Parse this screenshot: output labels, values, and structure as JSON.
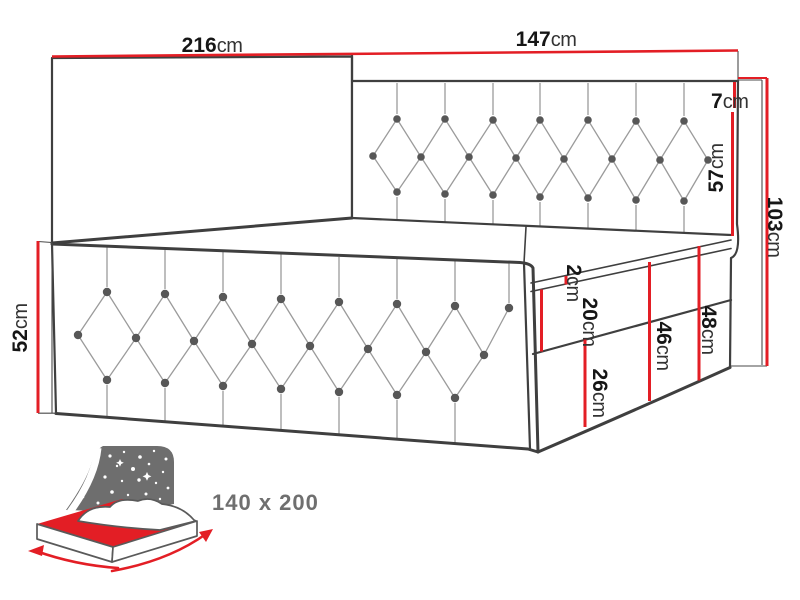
{
  "dims": {
    "length": {
      "num": "216",
      "unit": "cm"
    },
    "width": {
      "num": "147",
      "unit": "cm"
    },
    "headboard_top": {
      "num": "7",
      "unit": "cm"
    },
    "headboard": {
      "num": "57",
      "unit": "cm"
    },
    "height": {
      "num": "103",
      "unit": "cm"
    },
    "side": {
      "num": "52",
      "unit": "cm"
    },
    "piping": {
      "num": "2",
      "unit": "cm"
    },
    "mattress": {
      "num": "20",
      "unit": "cm"
    },
    "base_lower": {
      "num": "26",
      "unit": "cm"
    },
    "base_upper": {
      "num": "46",
      "unit": "cm"
    },
    "base_total": {
      "num": "48",
      "unit": "cm"
    }
  },
  "badge": {
    "size_label": "140 x 200",
    "icon": "bed-size-icon"
  },
  "colors": {
    "dimension_red": "#e31e25",
    "outline_dark": "#3f3f3f",
    "extension_gray": "#4a4a4a",
    "tuft_line_gray": "#9b9b9b",
    "button_gray": "#575757",
    "label_dark": "#161616",
    "label_unit": "#333333",
    "icon_gray": "#6e6e6e",
    "badge_text_gray": "#6f6f6f"
  }
}
